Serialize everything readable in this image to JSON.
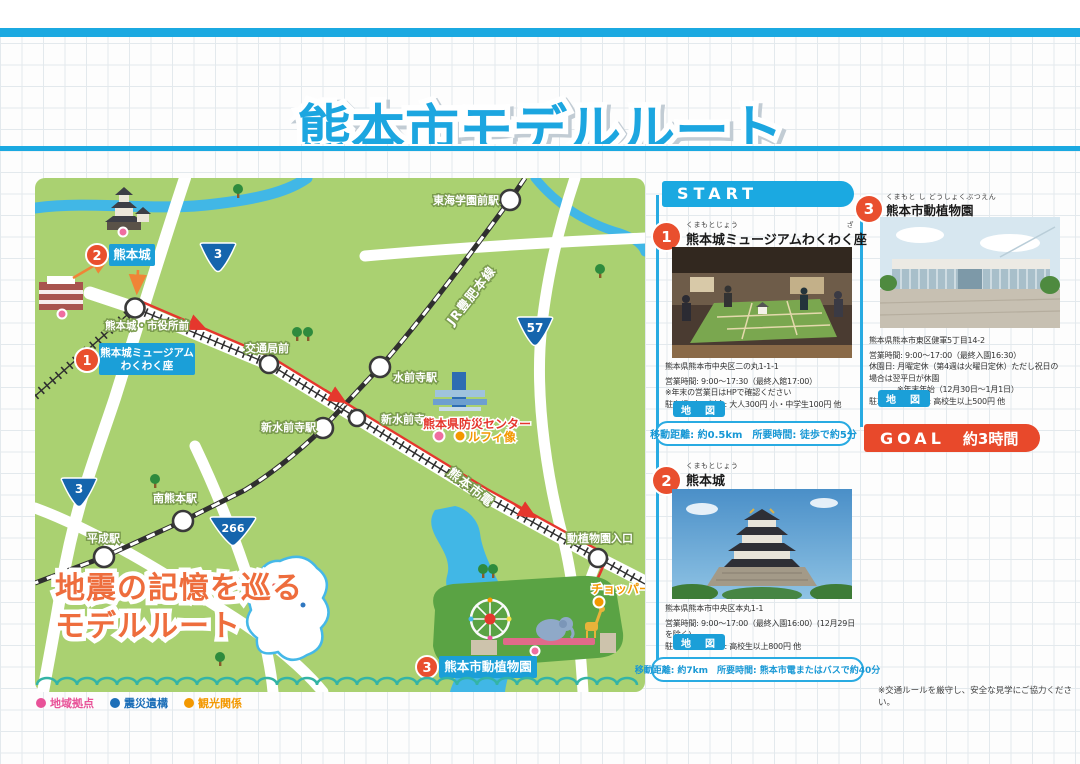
{
  "title": "熊本市モデルルート",
  "map": {
    "slogan_line1": "地震の記憶を巡る",
    "slogan_line2": "モデルルート",
    "shields": {
      "n3_top": "3",
      "n57": "57",
      "n3_left": "3",
      "n266": "266"
    },
    "rails": {
      "jr_line": "JR豊肥本線",
      "tram_line": "熊本市電"
    },
    "stations": {
      "tokai_gakuen_mae": "東海学園前駅",
      "suizenji": "水前寺駅",
      "kotsukyoku_mae": "交通局前",
      "shin_suizenji_st": "新水前寺駅",
      "shin_suizenji_tram": "新水前寺",
      "minami_kumamoto": "南熊本駅",
      "heisei": "平成駅",
      "kumamotojo_shiyakusho_mae": "熊本城・市役所前",
      "doshokubutsuen_iriguchi": "動植物園入口"
    },
    "poi": {
      "bosai_center": "熊本県防災センター",
      "luffy_statue": "ルフィ像",
      "chopper_statue": "チョッパー像"
    },
    "markers": {
      "stop1": {
        "num": "1",
        "line1": "熊本城ミュージアム",
        "line2": "わくわく座"
      },
      "stop2": {
        "num": "2",
        "label": "熊本城"
      },
      "stop3": {
        "num": "3",
        "label": "熊本市動植物園"
      }
    },
    "legend": [
      {
        "label": "地域拠点",
        "color": "#e85298"
      },
      {
        "label": "震災遺構",
        "color": "#1d6fb8"
      },
      {
        "label": "観光関係",
        "color": "#f39800"
      }
    ]
  },
  "panel": {
    "start_label": "START",
    "goal_label": "GOAL",
    "goal_time": "約3時間",
    "footnote": "※交通ルールを厳守し、安全な見学にご協力ください。",
    "stops": [
      {
        "num": "1",
        "furigana": "くまもとじょう",
        "furigana2": "ざ",
        "name": "熊本城ミュージアムわくわく座",
        "address": "熊本県熊本市中央区二の丸1-1-1",
        "hours": "営業時間: 9:00～17:30（最終入館17:00）",
        "note": "※年末の営業日はHPで確認ください",
        "parking": "駐車場: 有　料金: 大人300円 小・中学生100円 他",
        "map_label": "地　図",
        "transfer": "移動距離: 約0.5km　所要時間: 徒歩で約5分"
      },
      {
        "num": "2",
        "furigana": "くまもとじょう",
        "name": "熊本城",
        "address": "熊本県熊本市中央区本丸1-1",
        "hours": "営業時間: 9:00～17:00（最終入園16:00）(12月29日を除く)",
        "parking": "駐車場: 有　料金: 高校生以上800円 他",
        "map_label": "地　図",
        "transfer": "移動距離: 約7km　所要時間: 熊本市電またはバスで約40分"
      },
      {
        "num": "3",
        "furigana": "くまもと し どうしょくぶつえん",
        "name": "熊本市動植物園",
        "address": "熊本県熊本市東区健軍5丁目14-2",
        "hours": "営業時間: 9:00～17:00（最終入園16:30）",
        "closed": "休園日: 月曜定休（第4週は火曜日定休）ただし祝日の場合は翌平日が休園",
        "closed_note": "※年末年始（12月30日～1月1日）",
        "parking": "駐車場: 有　料金: 高校生以上500円 他",
        "map_label": "地　図"
      }
    ]
  },
  "colors": {
    "accent_blue": "#1ba9e1",
    "accent_red": "#e8492b",
    "route_red": "#e5372d",
    "map_green": "#aad171"
  }
}
